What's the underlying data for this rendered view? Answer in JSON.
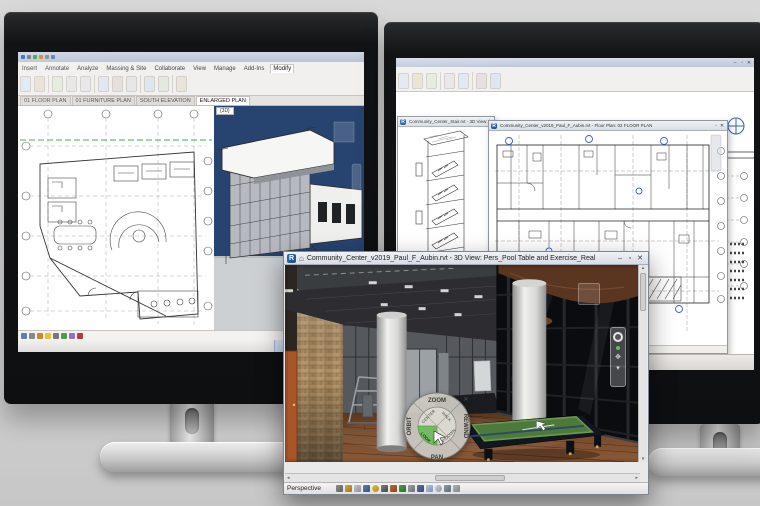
{
  "front_window": {
    "title": "Community_Center_v2019_Paul_F_Aubin.rvt - 3D View: Pers_Pool Table and Exercise_Real",
    "status_view_type": "Perspective",
    "wheel": {
      "zoom": "ZOOM",
      "orbit": "ORBIT",
      "pan": "PAN",
      "rewind": "REWIND",
      "center": "CENTER",
      "walk": "WALK",
      "look": "LOOK",
      "up_down": "UP/DOWN"
    }
  },
  "left_monitor": {
    "ribbon_tabs": [
      "Insert",
      "Annotate",
      "Analyze",
      "Massing & Site",
      "Collaborate",
      "View",
      "Manage",
      "Add-Ins",
      "Modify"
    ],
    "view_tabs": [
      "01 FLOOR PLAN",
      "01 FURNITURE PLAN",
      "SOUTH ELEVATION",
      "ENLARGED PLAN"
    ],
    "view3d_label": "{3D}"
  },
  "right_monitor": {
    "stair_window_title": "Community_Center_Stair.rvt - 3D View: {3D}",
    "plan_window_title": "Community_Center_v2019_Paul_F_Aubin.rvt - Floor Plan: 02 FLOOR PLAN"
  },
  "icons": {
    "revit_logo": "R",
    "home": "⌂",
    "minimize": "–",
    "maximize": "▫",
    "close": "✕",
    "scroll_up": "▴",
    "scroll_down": "▾",
    "scroll_left": "◂",
    "scroll_right": "▸",
    "pan_hand": "✥",
    "wheel_close": "✕",
    "chevron_down": "▾"
  },
  "colors": {
    "accent_blue": "#2f62c4",
    "felt_green": "#4d7a3b",
    "wheel_highlight": "#72bd60",
    "wood_floor": "#6e4426",
    "sky": "#27436f"
  }
}
